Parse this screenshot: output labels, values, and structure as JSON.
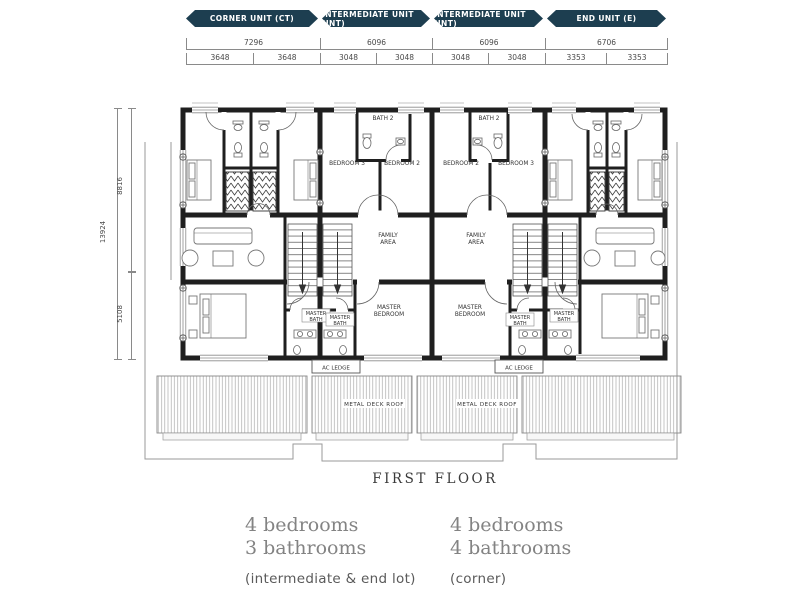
{
  "colors": {
    "banner_teal": "#1d3e50",
    "wall_black": "#1f1f1f",
    "dim_gray": "#8a8a8a",
    "summary_gray": "#838383"
  },
  "banners": [
    {
      "label": "CORNER UNIT (CT)"
    },
    {
      "label": "INTERMEDIATE UNIT (INT)"
    },
    {
      "label": "INTERMEDIATE UNIT (INT)"
    },
    {
      "label": "END UNIT (E)"
    }
  ],
  "dimensions": {
    "row1": [
      "7296",
      "6096",
      "6096",
      "6706"
    ],
    "row2": [
      "3648",
      "3648",
      "3048",
      "3048",
      "3048",
      "3048",
      "3353",
      "3353"
    ],
    "left_total": "13924",
    "left_upper": "8816",
    "left_lower": "5108"
  },
  "plan": {
    "labels": {
      "bath2": "BATH 2",
      "bedroom2": "BEDROOM 2",
      "bedroom3": "BEDROOM 3",
      "family1": "FAMILY",
      "family2": "AREA",
      "master1": "MASTER",
      "master2": "BEDROOM",
      "mbath1": "MASTER",
      "mbath2": "BATH",
      "ac_ledge": "AC LEDGE",
      "deck": "METAL DECK ROOF"
    }
  },
  "caption": "FIRST FLOOR",
  "summary": {
    "left": {
      "bedrooms": "4 bedrooms",
      "bathrooms": "3 bathrooms",
      "note": "(intermediate & end lot)"
    },
    "right": {
      "bedrooms": "4 bedrooms",
      "bathrooms": "4 bathrooms",
      "note": "(corner)"
    }
  }
}
